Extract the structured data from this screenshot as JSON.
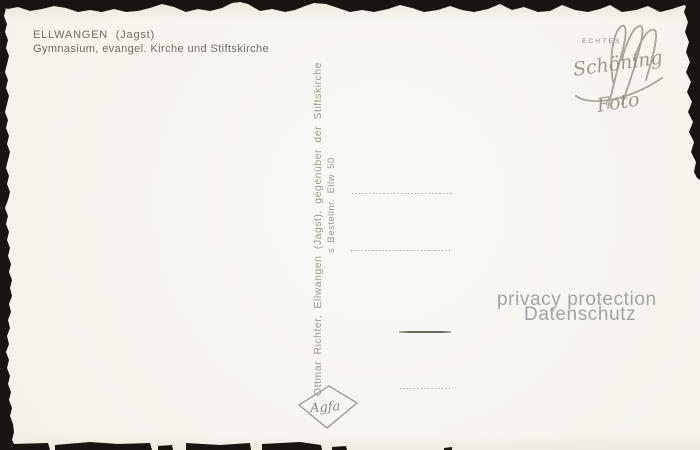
{
  "card": {
    "location": "ELLWANGEN  (Jagst)",
    "caption": "Gymnasium, evangel. Kirche und Stiftskirche"
  },
  "publisher": {
    "line1": "Ottmar Richter, Ellwangen (Jagst), gegenüber der Stiftskirche",
    "line2": "s Bestellnr. Ellw 50"
  },
  "logos": {
    "schoening": {
      "top_label": "ECHTES",
      "name": "Schöning",
      "word": "Foto"
    },
    "film_brand": "Agfa"
  },
  "watermark": {
    "line1": "privacy protection",
    "line2": "Datenschutz"
  },
  "colors": {
    "paper": "#f7f4ee",
    "title_ink": "#6f6b62",
    "imprint_ink": "#9c988c",
    "logo_ink": "#8d897e",
    "watermark_gray": "#a3a3a3",
    "torn_edge_black": "#18140f"
  }
}
